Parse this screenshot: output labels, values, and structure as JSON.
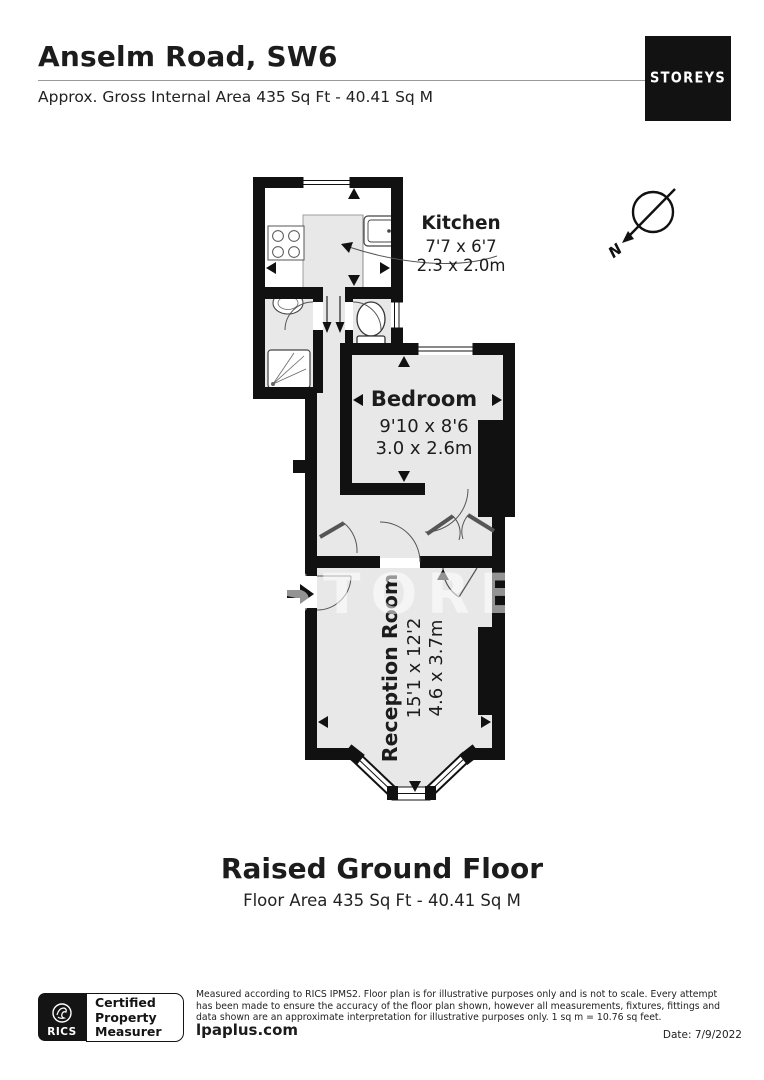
{
  "header": {
    "title": "Anselm Road, SW6",
    "subtitle": "Approx. Gross Internal Area 435 Sq Ft - 40.41 Sq M",
    "brand": "STOREYS"
  },
  "floorplan": {
    "watermark": "STOREYS",
    "compass": "N",
    "rooms": [
      {
        "name": "Kitchen",
        "dims_ft": "7'7 x 6'7",
        "dims_m": "2.3 x 2.0m"
      },
      {
        "name": "Bedroom",
        "dims_ft": "9'10 x 8'6",
        "dims_m": "3.0 x 2.6m"
      },
      {
        "name": "Reception Room",
        "dims_ft": "15'1 x 12'2",
        "dims_m": "4.6 x 3.7m"
      }
    ]
  },
  "floor_caption": {
    "title": "Raised Ground Floor",
    "subtitle": "Floor Area 435 Sq Ft - 40.41 Sq M"
  },
  "footer": {
    "rics": "RICS",
    "certified": [
      "Certified",
      "Property",
      "Measurer"
    ],
    "disclaimer": [
      "Measured according to RICS IPMS2. Floor plan is for illustrative purposes only and is not to scale. Every attempt",
      "has been made to ensure the accuracy of the floor plan shown, however all measurements, fixtures, fittings and",
      "data shown are an approximate interpretation for illustrative purposes only. 1 sq m = 10.76 sq feet."
    ],
    "website": "lpaplus.com",
    "date": "Date: 7/9/2022"
  },
  "colors": {
    "wall": "#111111",
    "floor": "#e8e8e8",
    "text": "#1f1f1f"
  }
}
